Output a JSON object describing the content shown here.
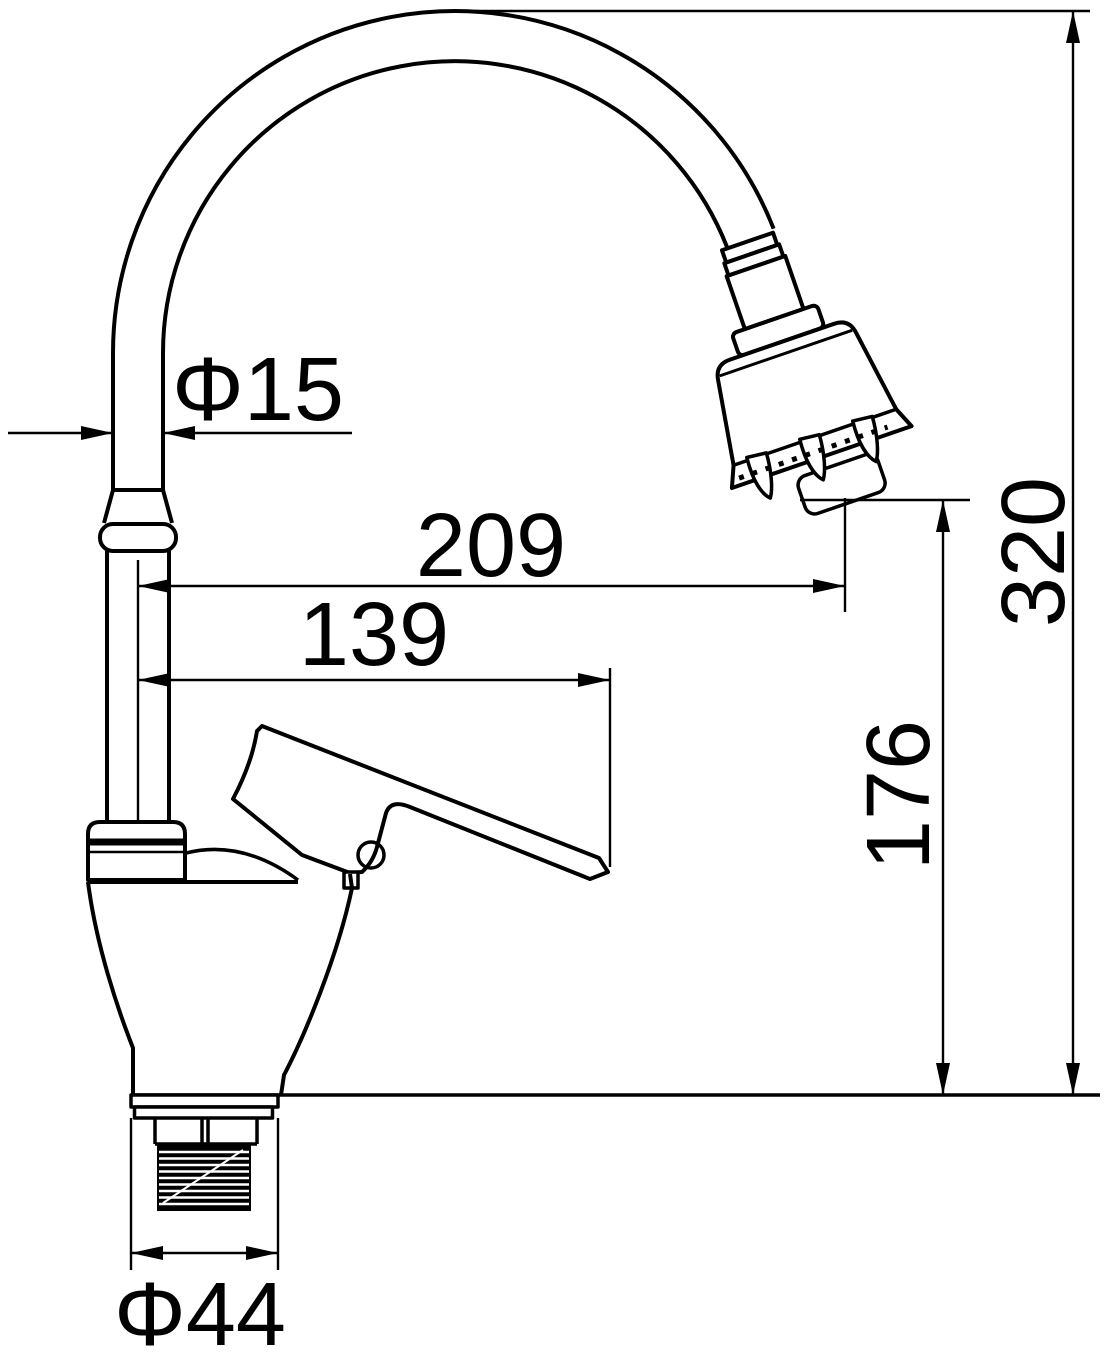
{
  "drawing": {
    "background_color": "#ffffff",
    "line_color": "#000000",
    "labels": {
      "spout_tube_diameter": "Φ15",
      "spout_reach": "209",
      "handle_reach": "139",
      "outlet_height": "176",
      "overall_height": "320",
      "base_thread_diameter": "Φ44"
    }
  }
}
